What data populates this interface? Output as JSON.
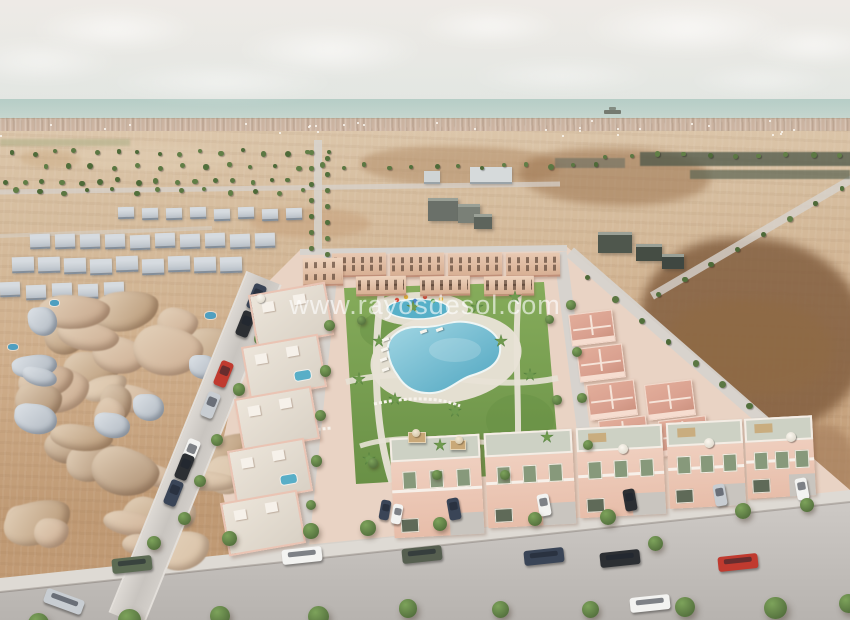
{
  "watermark": {
    "text": "www.rayosdesol.com"
  },
  "scene": {
    "description": "Aerial 3D visualisation of a new-build Mediterranean villa development with communal pools and gardens, bordered by an existing town on the left, bare dirt fields on the right, and the sea on the horizon",
    "features": [
      "sea horizon with cargo ship",
      "distant coastal town strip",
      "dirt fields with rows of trees and roads",
      "existing low-poly town on the left",
      "new pink villa development with apartments",
      "communal garden with two turquoise pools, palm trees and sun loungers",
      "villas with roof terraces and parasols",
      "street with parked cars and pavement trees"
    ],
    "colors": {
      "sky_top": "#ece9e5",
      "sky_bottom": "#e2e6e2",
      "sea_top": "#b2cbc4",
      "sea_bottom": "#c9d8d1",
      "ship": "#6e746a",
      "town_strip": "#cdb4a1",
      "green_strip": "#97a474",
      "field_light": "#dcc6aa",
      "field_mid": "#cfae8b",
      "field_dark": "#bf9973",
      "road_light": "#d7d3ce",
      "sidewalk": "#dedad4",
      "dev_base": "#e9d3c4",
      "dev_wall": "#f0cfc0",
      "roof_salmon": "#d9a08f",
      "ridge_white": "#f6e4d9",
      "terrace": "#cdd1c4",
      "shutter_green": "#87997b",
      "lawn": "#7ba351",
      "lawn_dark": "#5f8a3e",
      "tree": "#587540",
      "tree_light": "#7da35b",
      "palm": "#3f6b33",
      "pool": "#58aec7",
      "deck": "#e8e2d6",
      "mesh_light": "#d8c0a5",
      "mesh_mid": "#c3a286",
      "mesh_dark": "#a7886a",
      "roof_white": "#c7cdd3",
      "car_white": "#f3f3f1",
      "car_black": "#2c2f33",
      "car_dark": "#3a4557",
      "car_red": "#c03a2f",
      "car_suv_green": "#5c6b53",
      "car_suv_grey": "#565f50",
      "car_silver": "#c8cdd2"
    }
  }
}
